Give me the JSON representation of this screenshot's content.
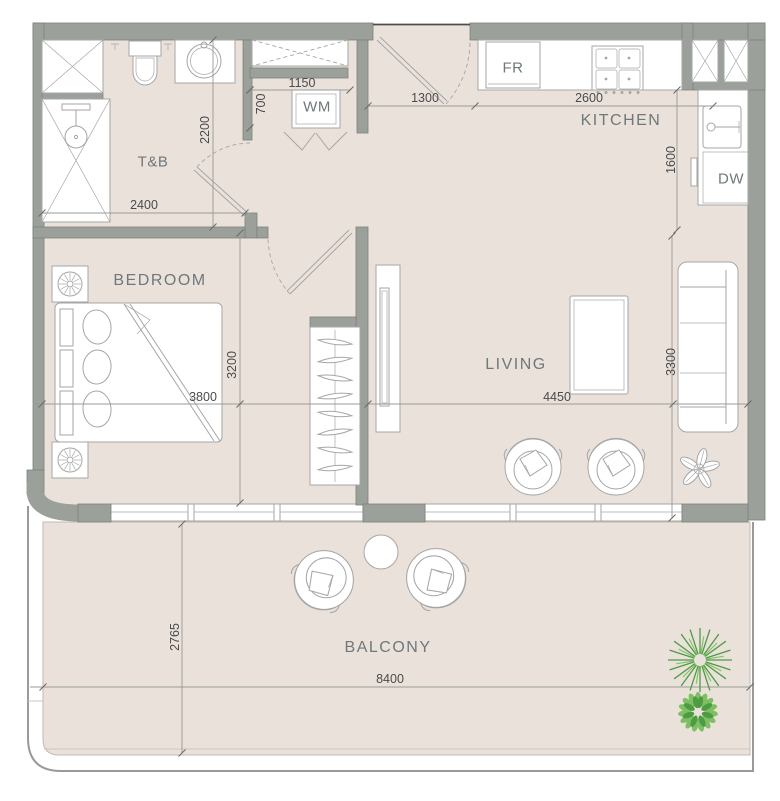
{
  "title": "Apartment floor plan",
  "rooms": {
    "tb": "T&B",
    "kitchen": "KITCHEN",
    "bedroom": "BEDROOM",
    "living": "LIVING",
    "balcony": "BALCONY"
  },
  "appliances": {
    "fr": "FR",
    "wm": "WM",
    "dw": "DW"
  },
  "dims": {
    "tb_w": "2400",
    "tb_h": "2200",
    "wm_w": "1150",
    "wm_d": "700",
    "entry_w": "1300",
    "kitchen_w": "2600",
    "kitchen_d": "1600",
    "bedroom_w": "3800",
    "bedroom_h": "3200",
    "living_w": "4450",
    "living_h": "3300",
    "balcony_d": "2765",
    "balcony_w": "8400"
  },
  "colors": {
    "paper": "#ffffff",
    "wall": "#9ba19a",
    "wall_edge": "#7c817b",
    "floor": "#eae1da",
    "line": "#a6a6a6",
    "dim_line": "#9a9a9a",
    "dim_text": "#4b4b4b",
    "label_text": "#6f787a",
    "plant_dark": "#4d9c43",
    "plant_light": "#7fbf64"
  }
}
